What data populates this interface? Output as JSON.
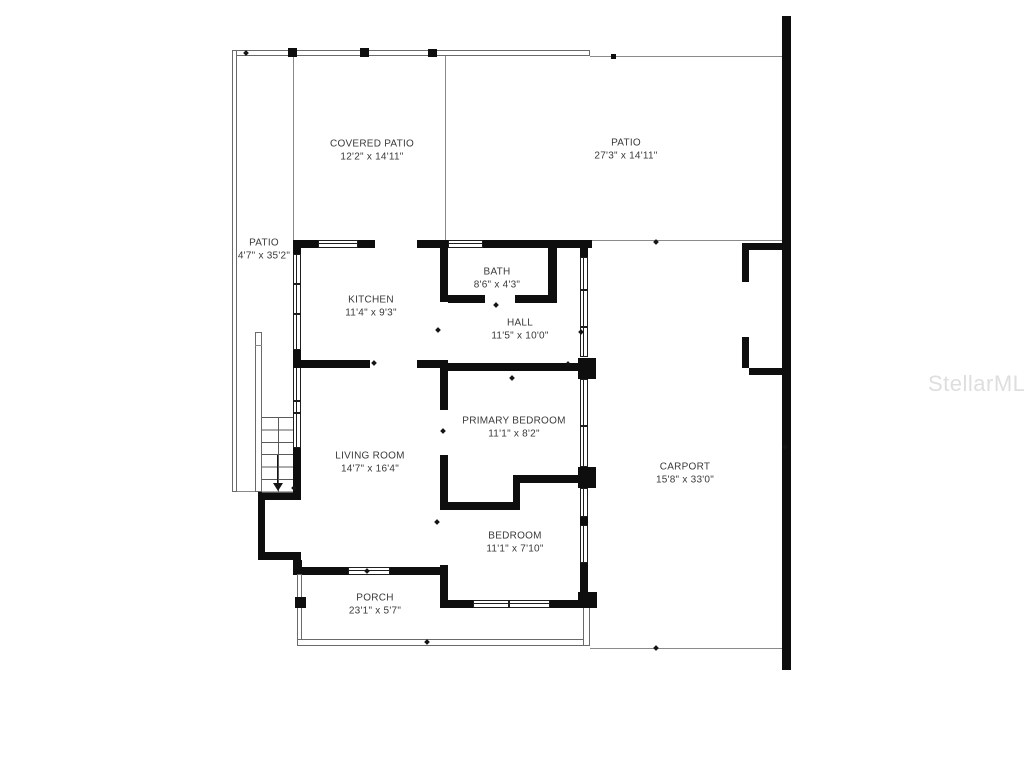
{
  "watermark": "StellarMLS",
  "rooms": {
    "covered_patio": {
      "name": "COVERED PATIO",
      "dims": "12'2\" x 14'11\""
    },
    "patio_top": {
      "name": "PATIO",
      "dims": "27'3\" x 14'11\""
    },
    "patio_left": {
      "name": "PATIO",
      "dims": "4'7\" x 35'2\""
    },
    "kitchen": {
      "name": "KITCHEN",
      "dims": "11'4\" x 9'3\""
    },
    "bath": {
      "name": "BATH",
      "dims": "8'6\" x 4'3\""
    },
    "hall": {
      "name": "HALL",
      "dims": "11'5\" x 10'0\""
    },
    "primary_bedroom": {
      "name": "PRIMARY BEDROOM",
      "dims": "11'1\" x 8'2\""
    },
    "living_room": {
      "name": "LIVING ROOM",
      "dims": "14'7\" x 16'4\""
    },
    "bedroom": {
      "name": "BEDROOM",
      "dims": "11'1\" x 7'10\""
    },
    "porch": {
      "name": "PORCH",
      "dims": "23'1\" x 5'7\""
    },
    "carport": {
      "name": "CARPORT",
      "dims": "15'8\" x 33'0\""
    }
  },
  "colors": {
    "wall": "#0e0e0e",
    "thin_line": "#8a8a8a",
    "text": "#3a3a3a",
    "watermark": "#dedede"
  }
}
